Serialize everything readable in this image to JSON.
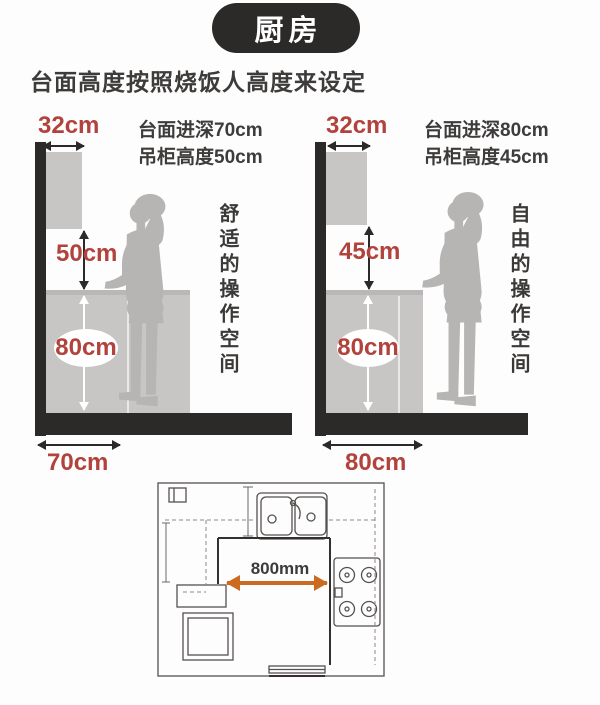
{
  "header": {
    "title": "厨房",
    "subtitle": "台面高度按照烧饭人高度来设定"
  },
  "left_diagram": {
    "cabinet_depth": "32cm",
    "note_line1": "台面进深70cm",
    "note_line2": "吊柜高度50cm",
    "gap_height": "50cm",
    "counter_height": "80cm",
    "counter_depth": "70cm",
    "caption": "舒适的操作空间"
  },
  "right_diagram": {
    "cabinet_depth": "32cm",
    "note_line1": "台面进深80cm",
    "note_line2": "吊柜高度45cm",
    "gap_height": "45cm",
    "counter_height": "80cm",
    "counter_depth": "80cm",
    "caption": "自由的操作空间"
  },
  "floor_plan": {
    "clearance": "800mm"
  },
  "colors": {
    "accent_red": "#b2423c",
    "dark": "#2b2a29",
    "cabinet_gray": "#c7c6c4",
    "person_gray": "#b7b5b3",
    "plan_orange": "#cc6a22",
    "text_dark": "#3e3c3a"
  }
}
